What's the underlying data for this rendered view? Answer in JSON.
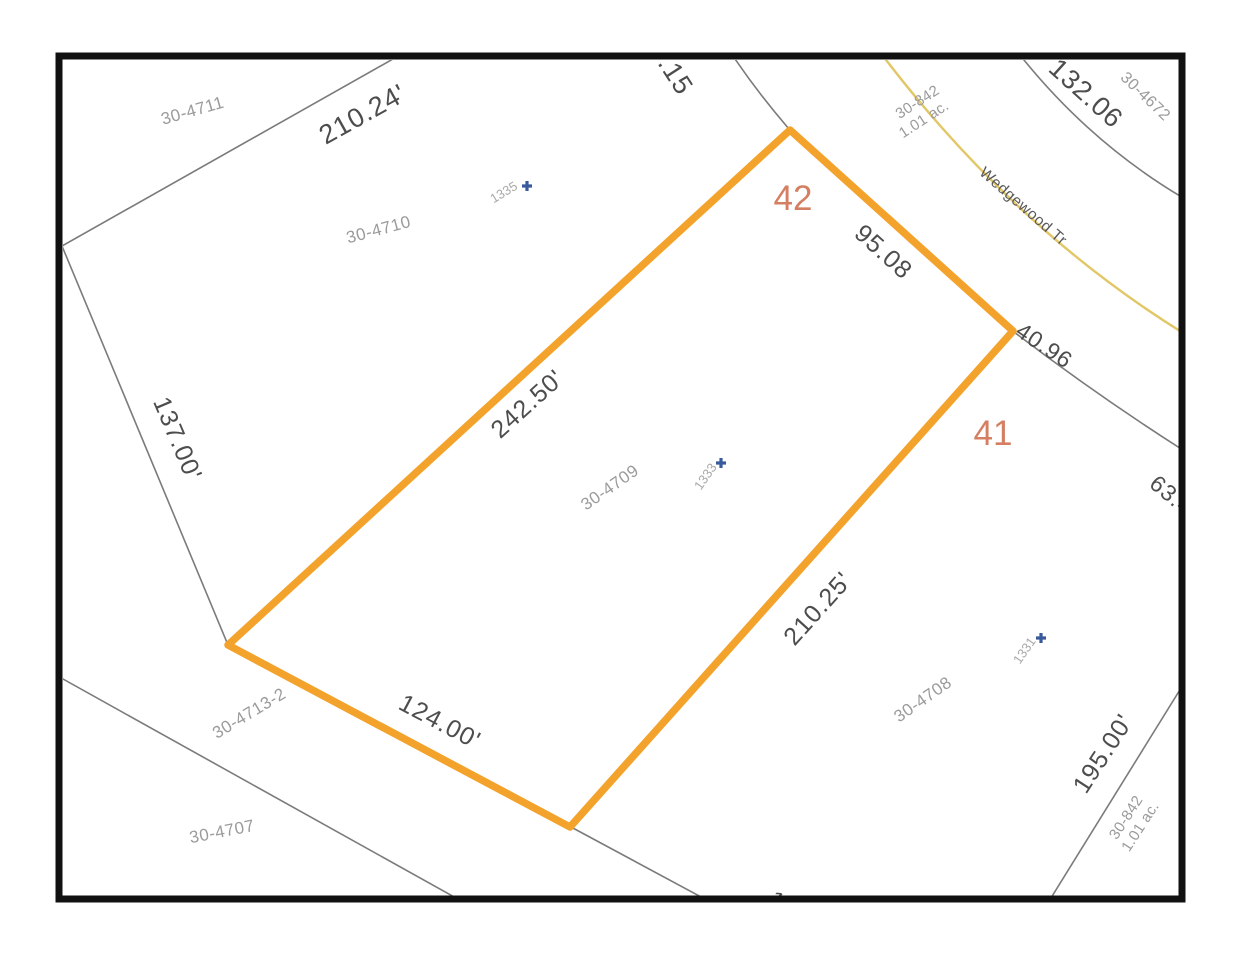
{
  "map": {
    "street": {
      "label": "Wedgewood Tr"
    },
    "lot_numbers": [
      {
        "label": "42"
      },
      {
        "label": "41"
      }
    ],
    "parcels": [
      {
        "id": "30-4711"
      },
      {
        "id": "30-4710"
      },
      {
        "id": "30-4709"
      },
      {
        "id": "30-4708"
      },
      {
        "id": "30-4713-2"
      },
      {
        "id": "30-4707"
      },
      {
        "id": "30-4672"
      }
    ],
    "acreage_labels": [
      {
        "id": "30-842",
        "area": "1.01 ac."
      },
      {
        "id": "30-842",
        "area": "1.01 ac."
      }
    ],
    "dimensions": [
      {
        "value": "210.24'"
      },
      {
        "value": ".15"
      },
      {
        "value": "132.06"
      },
      {
        "value": "137.00'"
      },
      {
        "value": "242.50'"
      },
      {
        "value": "95.08"
      },
      {
        "value": "40.96"
      },
      {
        "value": "63.46"
      },
      {
        "value": "210.25'"
      },
      {
        "value": "124.00'"
      },
      {
        "value": "195.00'"
      },
      {
        "value": "1"
      }
    ],
    "addresses": [
      {
        "number": "1335"
      },
      {
        "number": "1333"
      },
      {
        "number": "1331"
      }
    ],
    "colors": {
      "highlight": "#F3A32B",
      "road": "#E2C766",
      "lot_number": "#D57F62",
      "address_marker": "#3A5A9E",
      "boundary": "#7b7b7b",
      "dimension_text": "#4d4d4d",
      "parcel_label": "#9b9b9b",
      "frame": "#111111"
    }
  }
}
